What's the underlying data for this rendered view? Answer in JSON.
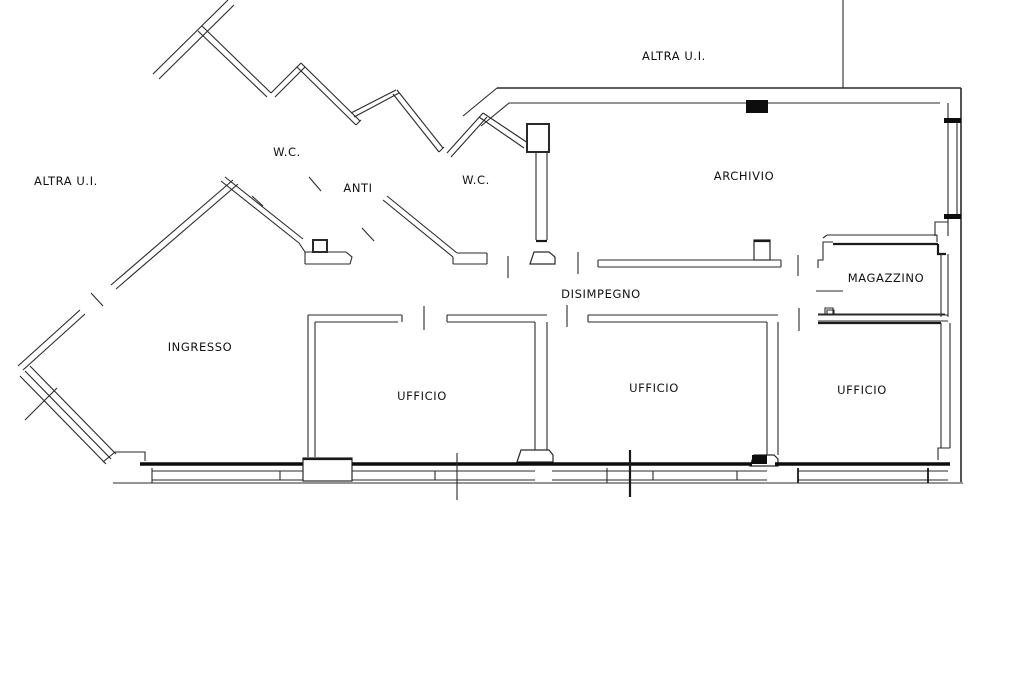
{
  "plan": {
    "type": "floor-plan",
    "background_color": "#ffffff",
    "line_color": "#1a1a1a",
    "language": "Italian"
  },
  "external_labels": [
    {
      "id": "altra-ui-top",
      "label": "ALTRA U.I."
    },
    {
      "id": "altra-ui-left",
      "label": "ALTRA U.I."
    }
  ],
  "rooms": [
    {
      "id": "wc-1",
      "label": "W.C."
    },
    {
      "id": "anti",
      "label": "ANTI"
    },
    {
      "id": "wc-2",
      "label": "W.C."
    },
    {
      "id": "archivio",
      "label": "ARCHIVIO"
    },
    {
      "id": "magazzino",
      "label": "MAGAZZINO"
    },
    {
      "id": "disimpegno",
      "label": "DISIMPEGNO"
    },
    {
      "id": "ingresso",
      "label": "INGRESSO"
    },
    {
      "id": "ufficio-1",
      "label": "UFFICIO"
    },
    {
      "id": "ufficio-2",
      "label": "UFFICIO"
    },
    {
      "id": "ufficio-3",
      "label": "UFFICIO"
    }
  ]
}
